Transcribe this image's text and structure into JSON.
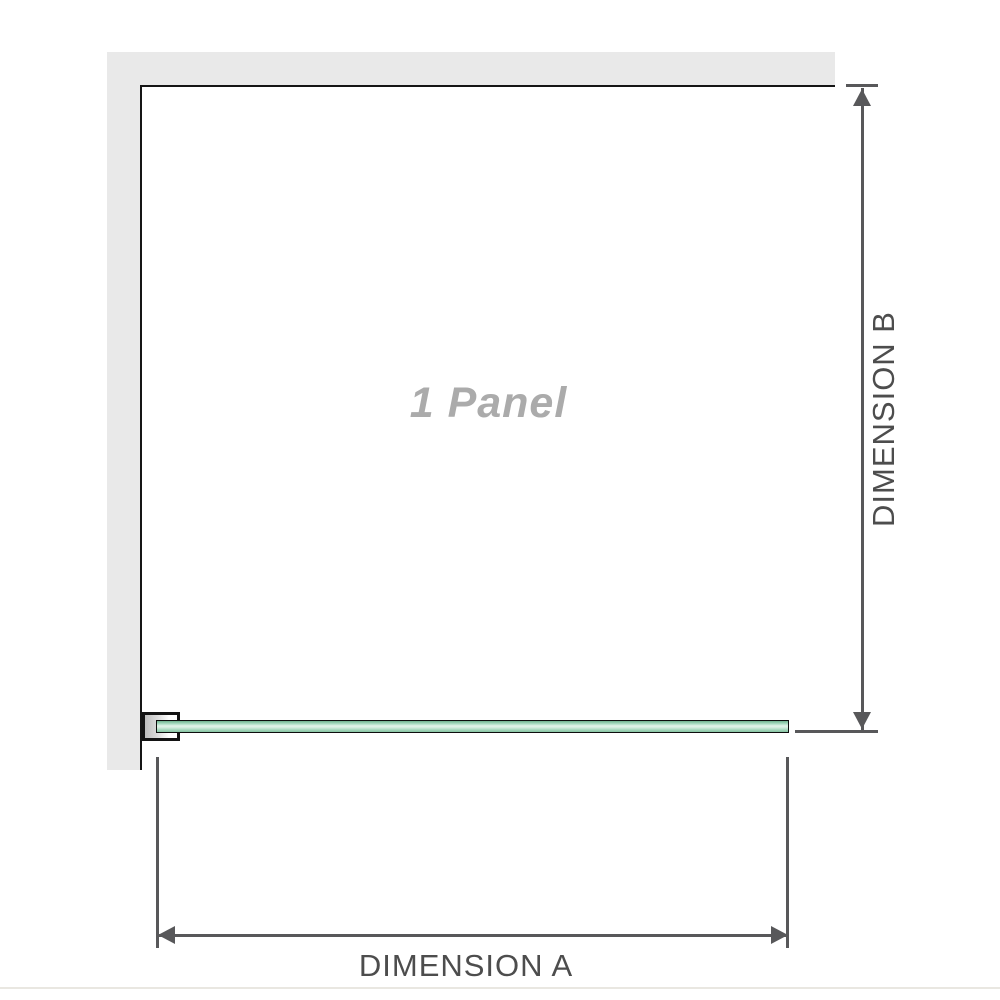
{
  "diagram": {
    "panel_label": "1 Panel",
    "dimension_a_label": "DIMENSION A",
    "dimension_b_label": "DIMENSION B"
  },
  "colors": {
    "wall": "#e9e9e9",
    "panel_border": "#151515",
    "dimension_line": "#58585a",
    "label_text": "#4d4d4d",
    "panel_label_text": "#ababab",
    "glass_border": "#0d0d0d",
    "glass_green_dark": "#6fb28f",
    "glass_green_mid": "#a6d8bd",
    "glass_green_light": "#e4f4eb",
    "bracket_fill": "#bdbdbd",
    "divider": "#e9e7e1"
  }
}
